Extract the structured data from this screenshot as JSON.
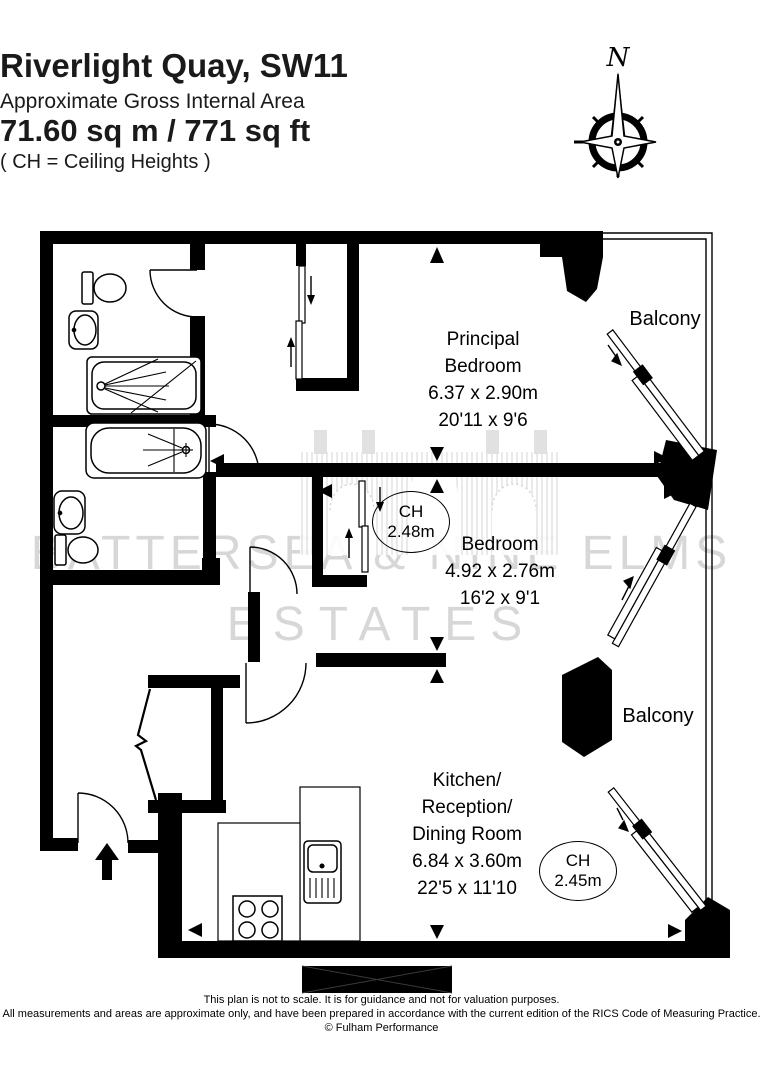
{
  "header": {
    "title": "Riverlight Quay, SW11",
    "subtitle": "Approximate Gross Internal Area",
    "area": "71.60 sq m  /  771 sq ft",
    "note": "( CH = Ceiling Heights )"
  },
  "compass": {
    "north_label": "N"
  },
  "rooms": {
    "principal_bedroom": {
      "name_line1": "Principal",
      "name_line2": "Bedroom",
      "dims_metric": "6.37 x 2.90m",
      "dims_imperial": "20'11 x 9'6"
    },
    "bedroom": {
      "name": "Bedroom",
      "dims_metric": "4.92 x 2.76m",
      "dims_imperial": "16'2 x 9'1"
    },
    "kitchen": {
      "name_line1": "Kitchen/",
      "name_line2": "Reception/",
      "name_line3": "Dining Room",
      "dims_metric": "6.84 x 3.60m",
      "dims_imperial": "22'5 x 11'10"
    },
    "balcony_top": {
      "name": "Balcony"
    },
    "balcony_bottom": {
      "name": "Balcony"
    }
  },
  "ceiling_heights": {
    "bedroom": {
      "label": "CH",
      "value": "2.48m"
    },
    "kitchen": {
      "label": "CH",
      "value": "2.45m"
    }
  },
  "watermark": {
    "line1": "BATTERSEA & NINE ELMS",
    "line2": "ESTATES"
  },
  "footer": {
    "line1": "This plan is not to scale. It is for guidance and not for valuation purposes.",
    "line2": "All measurements and areas are approximate only, and have been prepared in accordance with the current edition of the RICS Code of Measuring Practice.",
    "line3": "© Fulham Performance"
  },
  "colors": {
    "wall": "#000000",
    "background": "#ffffff",
    "watermark": "#d7d7d7"
  }
}
